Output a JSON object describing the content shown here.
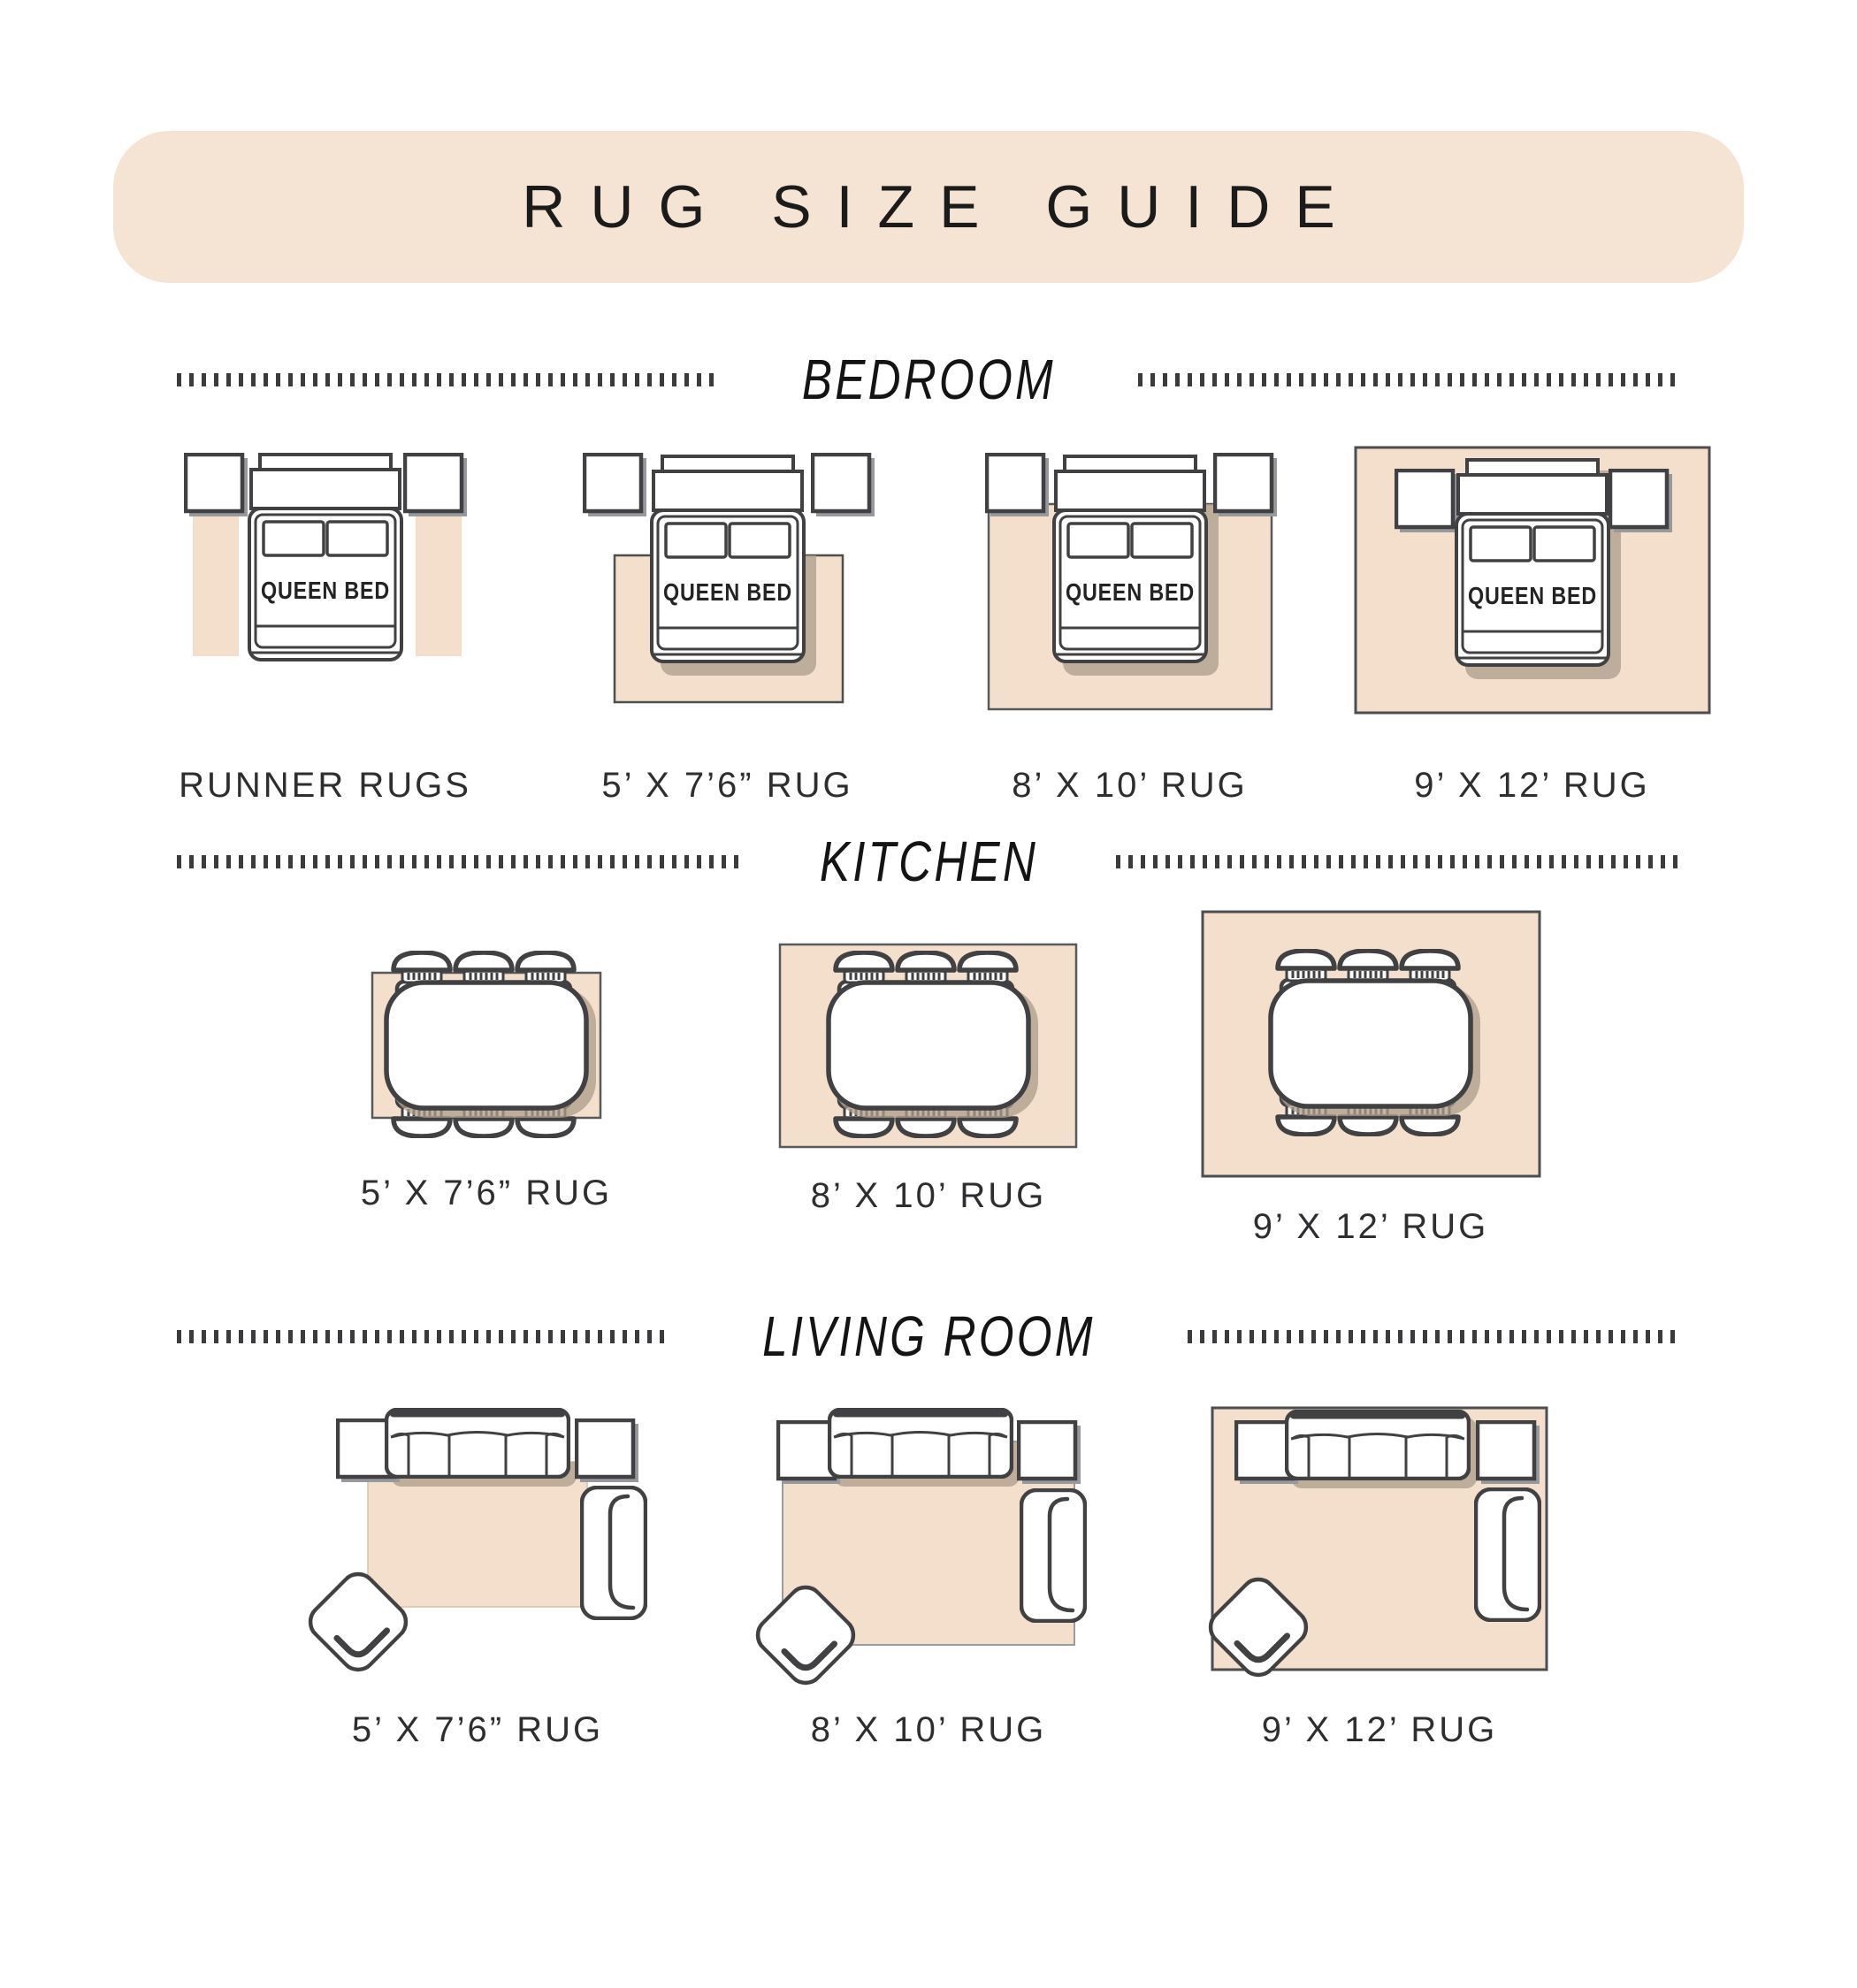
{
  "title": "RUG SIZE GUIDE",
  "bed_label": "QUEEN BED",
  "colors": {
    "banner_bg": "#f5e3d3",
    "rug_fill": "#f3dfcc",
    "outline_dark": "#414042",
    "rug_outline": "#58595b",
    "shadow_gray": "#97999c",
    "shadow_warm": "#ad9c8b",
    "text": "#232325"
  },
  "sections": [
    {
      "id": "bedroom",
      "label": "BEDROOM",
      "items": [
        {
          "label": "RUNNER RUGS"
        },
        {
          "label": "5’ X 7’6” RUG"
        },
        {
          "label": "8’ X 10’ RUG"
        },
        {
          "label": "9’ X 12’ RUG"
        }
      ]
    },
    {
      "id": "kitchen",
      "label": "KITCHEN",
      "items": [
        {
          "label": "5’ X 7’6” RUG"
        },
        {
          "label": "8’ X 10’ RUG"
        },
        {
          "label": "9’ X 12’ RUG"
        }
      ]
    },
    {
      "id": "living_room",
      "label": "LIVING ROOM",
      "items": [
        {
          "label": "5’ X 7’6” RUG"
        },
        {
          "label": "8’ X 10’ RUG"
        },
        {
          "label": "9’ X 12’ RUG"
        }
      ]
    }
  ]
}
